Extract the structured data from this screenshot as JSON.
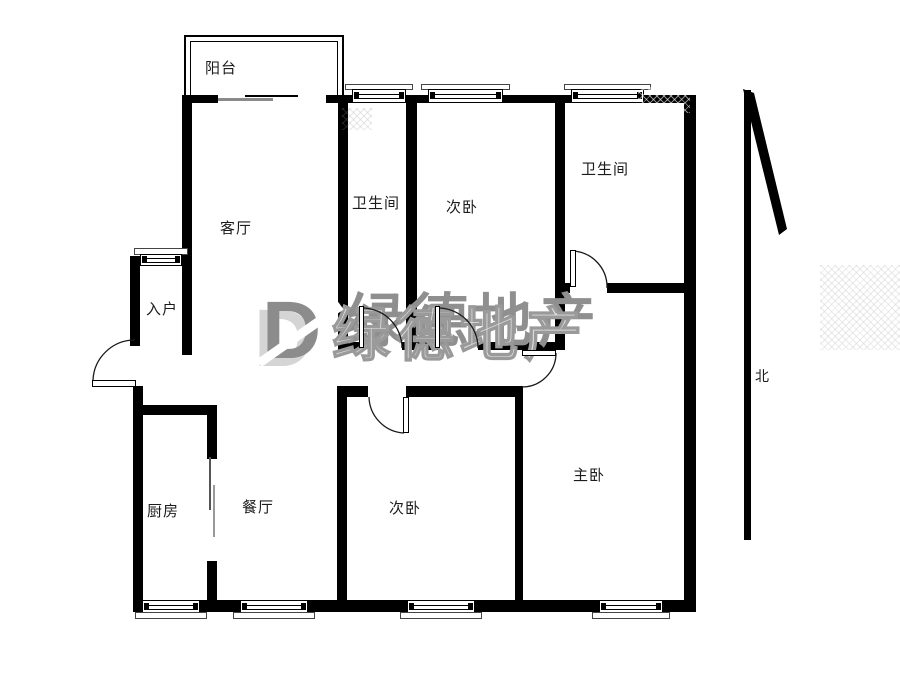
{
  "page": {
    "background": "#ffffff"
  },
  "rooms": [
    {
      "id": "balcony",
      "label": "阳台"
    },
    {
      "id": "living-room",
      "label": "客厅"
    },
    {
      "id": "entry",
      "label": "入户"
    },
    {
      "id": "bathroom-middle",
      "label": "卫生间"
    },
    {
      "id": "bedroom-top",
      "label": "次卧"
    },
    {
      "id": "bathroom-right",
      "label": "卫生间"
    },
    {
      "id": "kitchen",
      "label": "厨房"
    },
    {
      "id": "dining-room",
      "label": "餐厅"
    },
    {
      "id": "bedroom-bottom",
      "label": "次卧"
    },
    {
      "id": "master-bedroom",
      "label": "主卧"
    }
  ],
  "compass": {
    "label": "北"
  },
  "watermark": {
    "logo_letter": "D",
    "text": "绿德地产",
    "color_dark": "#8c8c8c",
    "color_light": "#dcdcdc"
  },
  "colors": {
    "wall": "#000000",
    "line": "#1a1a1a",
    "label_text": "#1c1c1c"
  }
}
